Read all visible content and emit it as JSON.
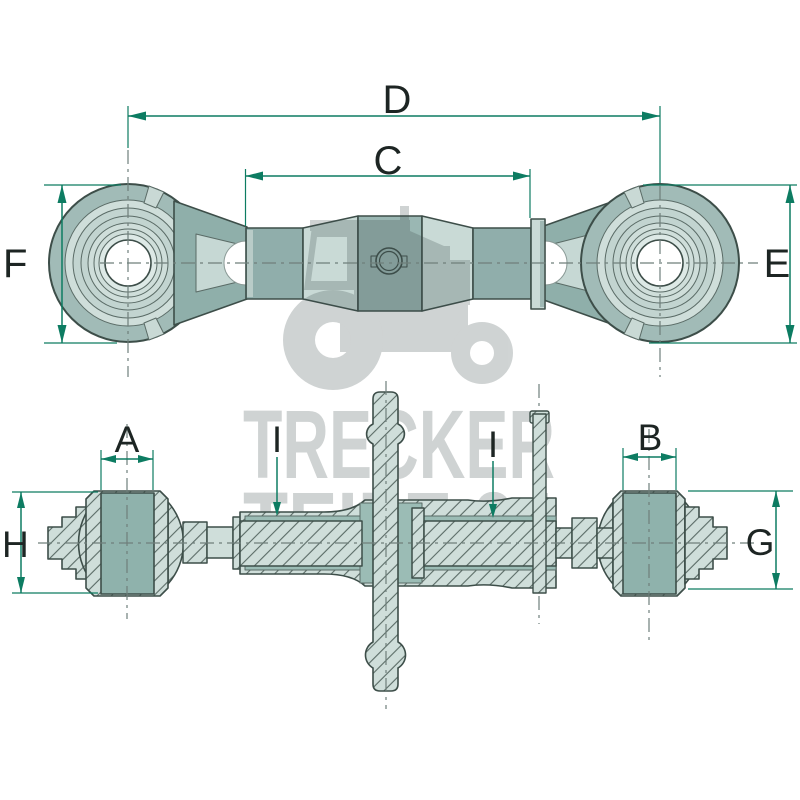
{
  "watermark": {
    "line1": "TRECKER",
    "line2": "TEILE 24"
  },
  "dimension_labels": {
    "overall_length": "D",
    "body_length": "C",
    "left_eye_height": "F",
    "right_eye_height": "E",
    "left_bushing_width": "A",
    "right_bushing_width": "B",
    "left_bushing_height": "H",
    "right_bushing_height": "G",
    "left_thread": "I",
    "right_thread": "I"
  },
  "colors": {
    "dimension_green": "#0d7c62",
    "label_dark": "#1d2523",
    "centerline_gray": "#6f7f7b",
    "outline_dark": "#3d4e49",
    "hatch_line": "#5a6b66",
    "part_light": "#cfdeda",
    "part_medium": "#90aeab",
    "part_pale": "#c9dad6",
    "eye_band": "#a1bbb7",
    "bushing_teal": "#8fb2ac",
    "cavity_teal": "#9bbcb5",
    "watermark_gray": "#3c4a4a"
  }
}
